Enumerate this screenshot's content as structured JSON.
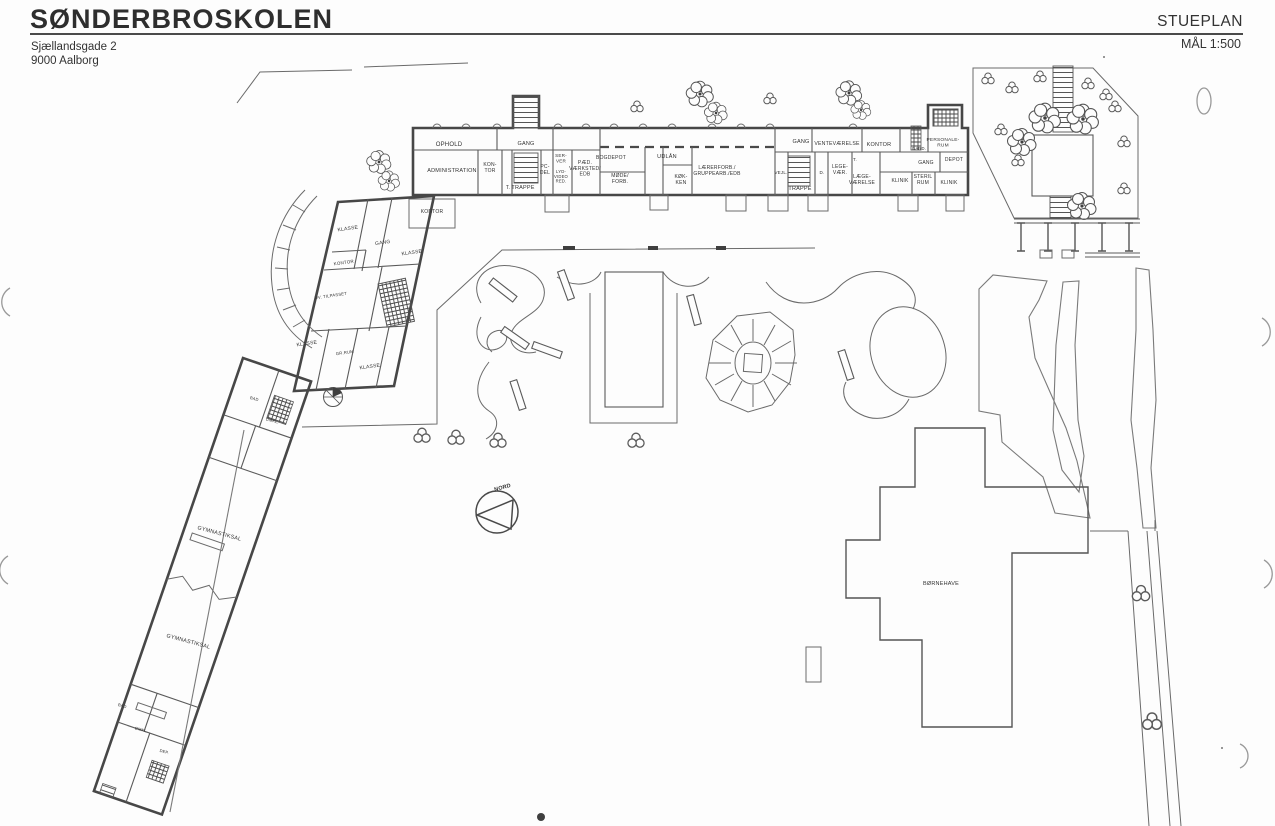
{
  "header": {
    "title": "SØNDERBROSKOLEN",
    "address_line1": "Sjællandsgade 2",
    "address_line2": "9000 Aalborg",
    "plan_name": "STUEPLAN",
    "scale": "MÅL 1:500"
  },
  "colors": {
    "paper": "#fdfdfd",
    "ink": "#474747",
    "label": "#333333"
  },
  "plan": {
    "compass_label": "NORD",
    "labels": [
      {
        "name": "room-label-ophold",
        "x": 449,
        "y": 146,
        "size": 6,
        "lines": [
          "OPHOLD"
        ]
      },
      {
        "name": "room-label-gang-west",
        "x": 526,
        "y": 145,
        "size": 5.5,
        "lines": [
          "GANG"
        ]
      },
      {
        "name": "room-label-administration",
        "x": 452,
        "y": 172,
        "size": 5.5,
        "lines": [
          "ADMINISTRATION"
        ]
      },
      {
        "name": "room-label-kontor-admin",
        "x": 490,
        "y": 166,
        "size": 5,
        "lines": [
          "KON-",
          "TOR"
        ]
      },
      {
        "name": "room-label-t-west",
        "x": 508,
        "y": 189,
        "size": 5,
        "lines": [
          "T."
        ]
      },
      {
        "name": "room-label-trappe-west",
        "x": 523,
        "y": 189,
        "size": 5.5,
        "lines": [
          "TRAPPE"
        ]
      },
      {
        "name": "room-label-pc-del",
        "x": 545,
        "y": 168,
        "size": 5,
        "lines": [
          "PC-",
          "DEL"
        ]
      },
      {
        "name": "room-label-server",
        "x": 561,
        "y": 157,
        "size": 4.6,
        "lines": [
          "SER-",
          "VER"
        ]
      },
      {
        "name": "room-label-lyd-video",
        "x": 561,
        "y": 173,
        "size": 4.2,
        "lines": [
          "LYD-",
          "VIDEO",
          "RED."
        ]
      },
      {
        "name": "room-label-paed-vaerksted",
        "x": 585,
        "y": 164,
        "size": 5,
        "lines": [
          "PÆD.",
          "VÆRKSTED/",
          "EDB"
        ]
      },
      {
        "name": "room-label-bogdepot",
        "x": 611,
        "y": 159,
        "size": 5,
        "lines": [
          "BOGDEPOT"
        ]
      },
      {
        "name": "room-label-udlaan",
        "x": 667,
        "y": 158,
        "size": 5.5,
        "lines": [
          "UDLÅN"
        ]
      },
      {
        "name": "room-label-moede-forb",
        "x": 620,
        "y": 177,
        "size": 5,
        "lines": [
          "MØDE/",
          "FORB."
        ]
      },
      {
        "name": "room-label-koekken",
        "x": 681,
        "y": 178,
        "size": 5,
        "lines": [
          "KØK-",
          "KEN"
        ]
      },
      {
        "name": "room-label-laererforb",
        "x": 717,
        "y": 169,
        "size": 5,
        "lines": [
          "LÆRERFORB./",
          "GRUPPEARB./EDB"
        ]
      },
      {
        "name": "room-label-gang-east",
        "x": 801,
        "y": 143,
        "size": 5.5,
        "lines": [
          "GANG"
        ]
      },
      {
        "name": "room-label-ventevaerelse",
        "x": 837,
        "y": 145,
        "size": 5.2,
        "lines": [
          "VENTEVÆRELSE"
        ]
      },
      {
        "name": "room-label-kontor-east",
        "x": 879,
        "y": 146,
        "size": 5.5,
        "lines": [
          "KONTOR"
        ]
      },
      {
        "name": "room-label-gard",
        "x": 919,
        "y": 150,
        "size": 4.2,
        "lines": [
          "GARD."
        ]
      },
      {
        "name": "room-label-personalerum",
        "x": 943,
        "y": 141,
        "size": 4.8,
        "lines": [
          "PERSONALE-",
          "RUM"
        ]
      },
      {
        "name": "room-label-vejl",
        "x": 781,
        "y": 174,
        "size": 4.5,
        "lines": [
          "VEJL."
        ]
      },
      {
        "name": "room-label-trappe-east",
        "x": 800,
        "y": 190,
        "size": 5.5,
        "lines": [
          "TRAPPE"
        ]
      },
      {
        "name": "room-label-d",
        "x": 822,
        "y": 174,
        "size": 4.5,
        "lines": [
          "D."
        ]
      },
      {
        "name": "room-label-legevaer",
        "x": 840,
        "y": 168,
        "size": 5,
        "lines": [
          "LEGE-",
          "VÆR."
        ]
      },
      {
        "name": "room-label-t-east",
        "x": 855,
        "y": 161,
        "size": 4.5,
        "lines": [
          "T."
        ]
      },
      {
        "name": "room-label-laegevaerelse",
        "x": 862,
        "y": 178,
        "size": 5,
        "lines": [
          "LÆGE-",
          "VÆRELSE"
        ]
      },
      {
        "name": "room-label-gang-klinik",
        "x": 926,
        "y": 164,
        "size": 5,
        "lines": [
          "GANG"
        ]
      },
      {
        "name": "room-label-depot",
        "x": 954,
        "y": 161,
        "size": 5,
        "lines": [
          "DEPOT"
        ]
      },
      {
        "name": "room-label-klinik-1",
        "x": 900,
        "y": 182,
        "size": 5,
        "lines": [
          "KLINIK"
        ]
      },
      {
        "name": "room-label-steril-rum",
        "x": 923,
        "y": 178,
        "size": 5,
        "lines": [
          "STERIL",
          "RUM"
        ]
      },
      {
        "name": "room-label-klinik-2",
        "x": 949,
        "y": 184,
        "size": 5,
        "lines": [
          "KLINIK"
        ]
      },
      {
        "name": "room-label-kontor-wing-top",
        "x": 432,
        "y": 213,
        "size": 5,
        "lines": [
          "KONTOR"
        ]
      },
      {
        "name": "room-label-klasse-1",
        "x": 348,
        "y": 230,
        "size": 5,
        "rot": -8,
        "lines": [
          "KLASSE"
        ]
      },
      {
        "name": "room-label-gang-wing",
        "x": 383,
        "y": 244,
        "size": 5,
        "rot": -8,
        "lines": [
          "GANG"
        ]
      },
      {
        "name": "room-label-klasse-2",
        "x": 412,
        "y": 254,
        "size": 5,
        "rot": -8,
        "lines": [
          "KLASSE"
        ]
      },
      {
        "name": "room-label-kontor-wing",
        "x": 344,
        "y": 264,
        "size": 4.5,
        "rot": -8,
        "lines": [
          "KONTOR"
        ]
      },
      {
        "name": "room-label-tilpasset",
        "x": 331,
        "y": 297,
        "size": 4.2,
        "rot": -8,
        "lines": [
          "UV. TILPASSET"
        ]
      },
      {
        "name": "room-label-klasse-3",
        "x": 307,
        "y": 345,
        "size": 5,
        "rot": -8,
        "lines": [
          "KLASSE"
        ]
      },
      {
        "name": "room-label-gr-rum",
        "x": 345,
        "y": 354,
        "size": 4.2,
        "rot": -8,
        "lines": [
          "GR.RUM"
        ]
      },
      {
        "name": "room-label-klasse-4",
        "x": 370,
        "y": 368,
        "size": 5,
        "rot": -8,
        "lines": [
          "KLASSE"
        ]
      },
      {
        "name": "room-label-gymnastiksal-1",
        "x": 219,
        "y": 535,
        "size": 5.5,
        "rot": 15,
        "lines": [
          "GYMNASTIKSAL"
        ]
      },
      {
        "name": "room-label-gymnastiksal-2",
        "x": 188,
        "y": 643,
        "size": 5.5,
        "rot": 15,
        "lines": [
          "GYMNASTIKSAL"
        ]
      },
      {
        "name": "room-label-bad-1",
        "x": 254,
        "y": 400,
        "size": 4,
        "rot": 15,
        "lines": [
          "BAD"
        ]
      },
      {
        "name": "room-label-omkl-1",
        "x": 272,
        "y": 422,
        "size": 4,
        "rot": 15,
        "lines": [
          "OMKL."
        ]
      },
      {
        "name": "room-label-bad-2",
        "x": 122,
        "y": 707,
        "size": 4,
        "rot": 15,
        "lines": [
          "BAD"
        ]
      },
      {
        "name": "room-label-omkl-2",
        "x": 141,
        "y": 731,
        "size": 4,
        "rot": 15,
        "lines": [
          "OMKL."
        ]
      },
      {
        "name": "room-label-dep",
        "x": 164,
        "y": 753,
        "size": 4,
        "rot": 15,
        "lines": [
          "DEP."
        ]
      },
      {
        "name": "compass-label-nord",
        "x": 503,
        "y": 489,
        "size": 5.5,
        "rot": -15,
        "bold": true,
        "lines": [
          "NORD"
        ]
      },
      {
        "name": "building-label-boernehave",
        "x": 941,
        "y": 585,
        "size": 5.5,
        "lines": [
          "BØRNEHAVE"
        ]
      }
    ]
  }
}
